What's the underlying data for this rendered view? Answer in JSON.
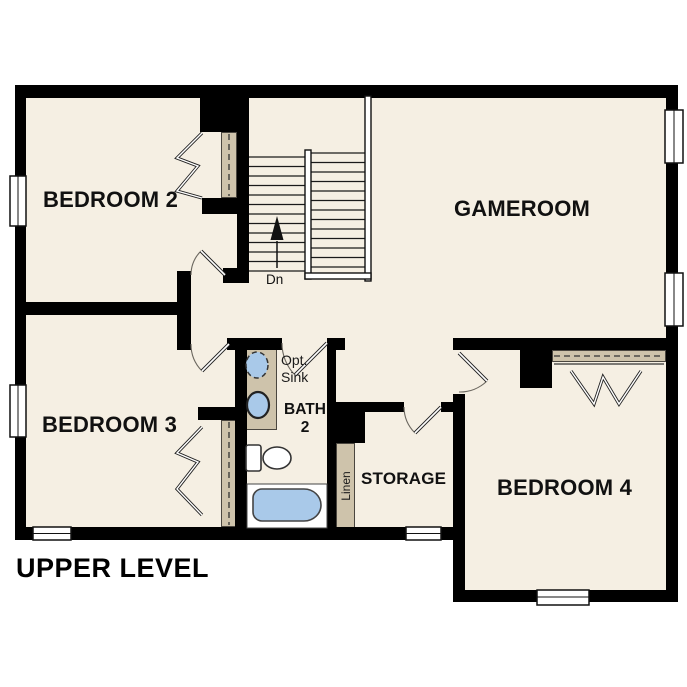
{
  "title": "UPPER LEVEL",
  "rooms": {
    "bedroom2": "BEDROOM 2",
    "bedroom3": "BEDROOM 3",
    "bedroom4": "BEDROOM 4",
    "gameroom": "GAMEROOM",
    "storage": "STORAGE",
    "bath_line1": "BATH",
    "bath_line2": "2"
  },
  "annotations": {
    "stairs_direction": "Dn",
    "optional_sink_line1": "Opt.",
    "optional_sink_line2": "Sink",
    "linen_closet": "Linen"
  },
  "colors": {
    "wall": "#000000",
    "floor": "#f5efe3",
    "outside": "#ffffff",
    "cabinetry": "#cec3ab",
    "plumbing_fixture_fill": "#a9c9e9",
    "fixture_outline": "#333333"
  }
}
